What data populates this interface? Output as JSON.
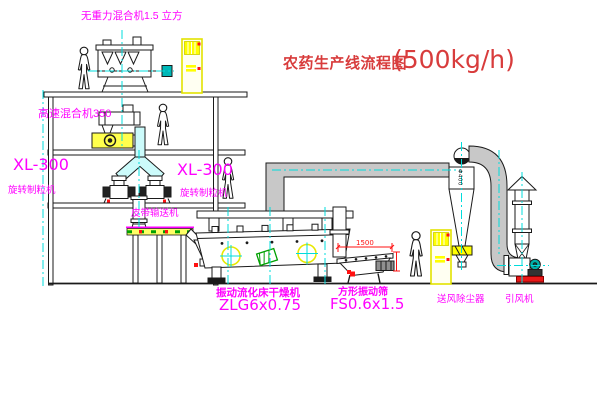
{
  "title": {
    "main": "农药生产线流程图",
    "capacity": "(500kg/h)"
  },
  "equipment_labels": {
    "gravity_mixer": "无重力混合机1.5 立方",
    "high_speed_mixer": "高速混合机350",
    "granulator_left": {
      "model": "XL-300",
      "name": "旋转制粒机"
    },
    "granulator_mid": {
      "model": "XL-300",
      "name": "旋转制粒机"
    },
    "belt_conveyor": "皮带输送机",
    "fluid_bed_dryer": {
      "name": "振动流化床干燥机",
      "model": "ZLG6x0.75"
    },
    "square_sieve": {
      "name": "方形振动筛",
      "model": "FS0.6x1.5",
      "dim": "1500"
    },
    "dust_collector": "送风除尘器",
    "induced_draft_fan": "引风机",
    "cyclone": {
      "dia": "Φ400"
    }
  },
  "colors": {
    "label_magenta": "#ff00ff",
    "title_red": "#d83c3c",
    "cabinet_yellow": "#f0f000",
    "centerline_cyan": "#00dcdc",
    "pipe_gray": "#c8c8c8",
    "motor_teal": "#00b0a8",
    "belt_yellow": "#ffff66",
    "belt_green": "#00a000",
    "accent_red": "#ff1111",
    "drawing_black": "#1a1a1a"
  }
}
